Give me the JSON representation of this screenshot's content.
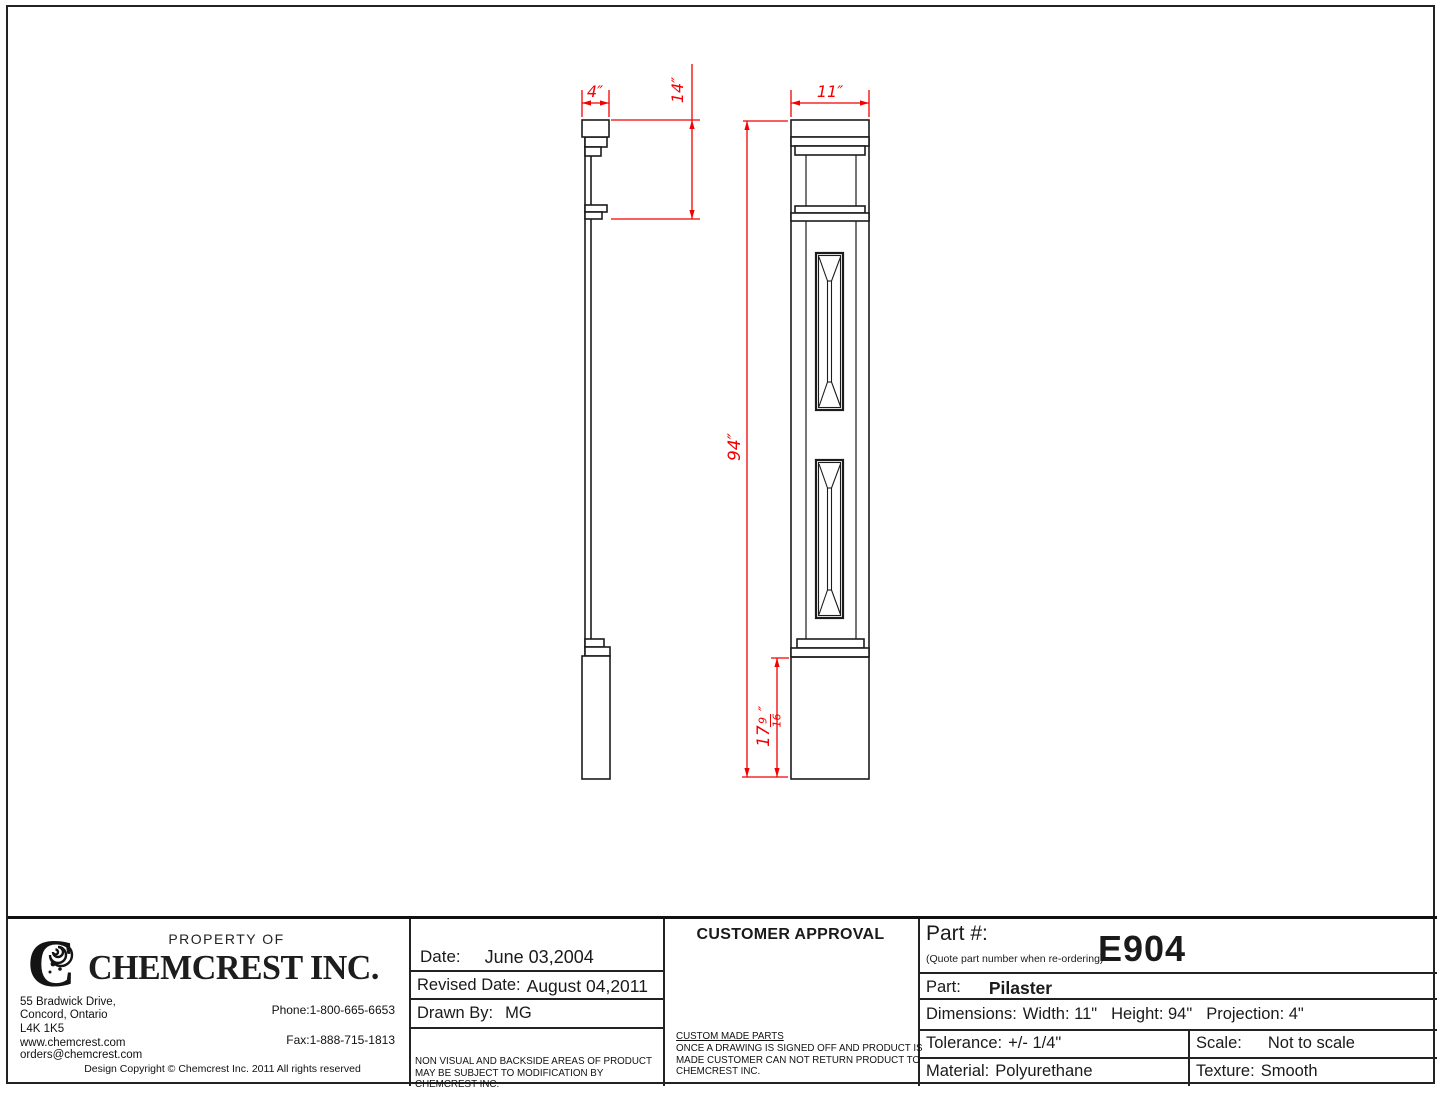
{
  "drawing": {
    "dim_color": "#f40000",
    "line_color": "#1c1c1c",
    "dims": {
      "projection": "4″",
      "capital_height": "14″",
      "width": "11″",
      "overall_height": "94″",
      "base": {
        "whole": "17",
        "num": "9",
        "den": "16",
        "unit": "″"
      }
    }
  },
  "title_block": {
    "company": {
      "property_of": "PROPERTY OF",
      "name": "CHEMCREST INC.",
      "logo_letter": "C",
      "address": [
        "55 Bradwick Drive,",
        "Concord, Ontario",
        "L4K 1K5",
        "www.chemcrest.com",
        "orders@chemcrest.com"
      ],
      "phone": "Phone:1-800-665-6653",
      "fax": "Fax:1-888-715-1813",
      "copyright": "Design Copyright © Chemcrest Inc. 2011 All rights reserved"
    },
    "dates": {
      "date_label": "Date:",
      "date_value": "June 03,2004",
      "revised_label": "Revised Date:",
      "revised_value": "August 04,2011",
      "drawn_label": "Drawn By:",
      "drawn_value": "MG",
      "note": "NON VISUAL AND BACKSIDE AREAS OF PRODUCT MAY BE SUBJECT TO MODIFICATION BY CHEMCREST INC."
    },
    "approval": {
      "header": "CUSTOMER APPROVAL",
      "note_title": "CUSTOM MADE PARTS",
      "note_body": "ONCE A DRAWING IS SIGNED OFF AND PRODUCT IS MADE CUSTOMER CAN NOT RETURN PRODUCT TO CHEMCREST INC."
    },
    "part": {
      "part_no_label": "Part #:",
      "part_no_hint": "(Quote part number when re-ordering)",
      "part_no": "E904",
      "part_label": "Part:",
      "part_value": "Pilaster",
      "dims_label": "Dimensions:",
      "dims_width": "Width: 11\"",
      "dims_height": "Height: 94\"",
      "dims_projection": "Projection: 4\"",
      "tolerance_label": "Tolerance:",
      "tolerance_value": "+/- 1/4\"",
      "scale_label": "Scale:",
      "scale_value": "Not to scale",
      "material_label": "Material:",
      "material_value": "Polyurethane",
      "texture_label": "Texture:",
      "texture_value": "Smooth"
    }
  }
}
